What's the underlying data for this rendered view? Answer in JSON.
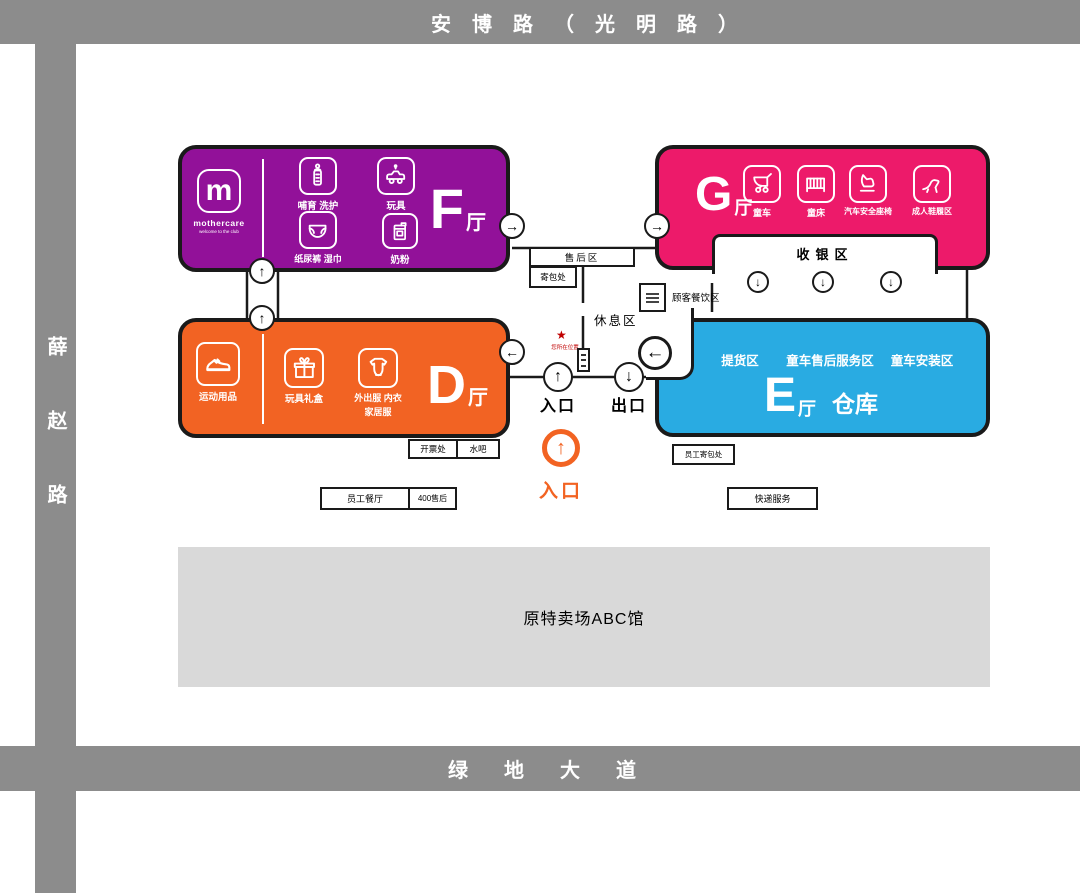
{
  "roads": {
    "top": "安博路（光明路）",
    "left": "薛赵路",
    "bottom": "绿地大道"
  },
  "halls": {
    "f": {
      "letter": "F",
      "suffix": "厅",
      "brand_initial": "m",
      "brand_name": "mothercare",
      "brand_tagline": "welcome to the club",
      "cat_feeding": "哺育 洗护",
      "cat_toys": "玩具",
      "cat_diapers": "纸尿裤 湿巾",
      "cat_milk": "奶粉"
    },
    "g": {
      "letter": "G",
      "suffix": "厅",
      "cat_strollers": "童车",
      "cat_cribs": "童床",
      "cat_carseats": "汽车安全座椅",
      "cat_shoes": "成人鞋履区"
    },
    "d": {
      "letter": "D",
      "suffix": "厅",
      "cat_sports": "运动用品",
      "cat_gifts": "玩具礼盒",
      "cat_clothes_1": "外出服 内衣",
      "cat_clothes_2": "家居服"
    },
    "e": {
      "letter": "E",
      "suffix": "厅",
      "extra": "仓库",
      "zone_pickup": "提货区",
      "zone_service": "童车售后服务区",
      "zone_install": "童车安装区"
    }
  },
  "areas": {
    "cashier": "收银区",
    "dining": "顾客餐饮区",
    "rest": "休息区",
    "after_sales": "售后区",
    "bag_check": "寄包处",
    "entrance": "入口",
    "exit": "出口",
    "main_entrance": "入口",
    "you_are_here": "您所在位置",
    "invoice": "开票处",
    "water_bar": "水吧",
    "staff_canteen": "员工餐厅",
    "hotline": "400售后",
    "staff_bag": "员工寄包处",
    "courier": "快递服务",
    "former_outlet": "原特卖场ABC馆"
  },
  "glyphs": {
    "up": "↑",
    "down": "↓",
    "left": "←",
    "right": "→",
    "star": "★"
  },
  "colors": {
    "road": "#8C8C8C",
    "hall_f": "#921199",
    "hall_g": "#ED1A6A",
    "hall_d": "#F26323",
    "hall_e": "#29ABE2",
    "outline": "#1A1A1A",
    "former_outlet_bg": "#D9D9D9",
    "accent": "#F26322",
    "marker_red": "#C00000"
  }
}
